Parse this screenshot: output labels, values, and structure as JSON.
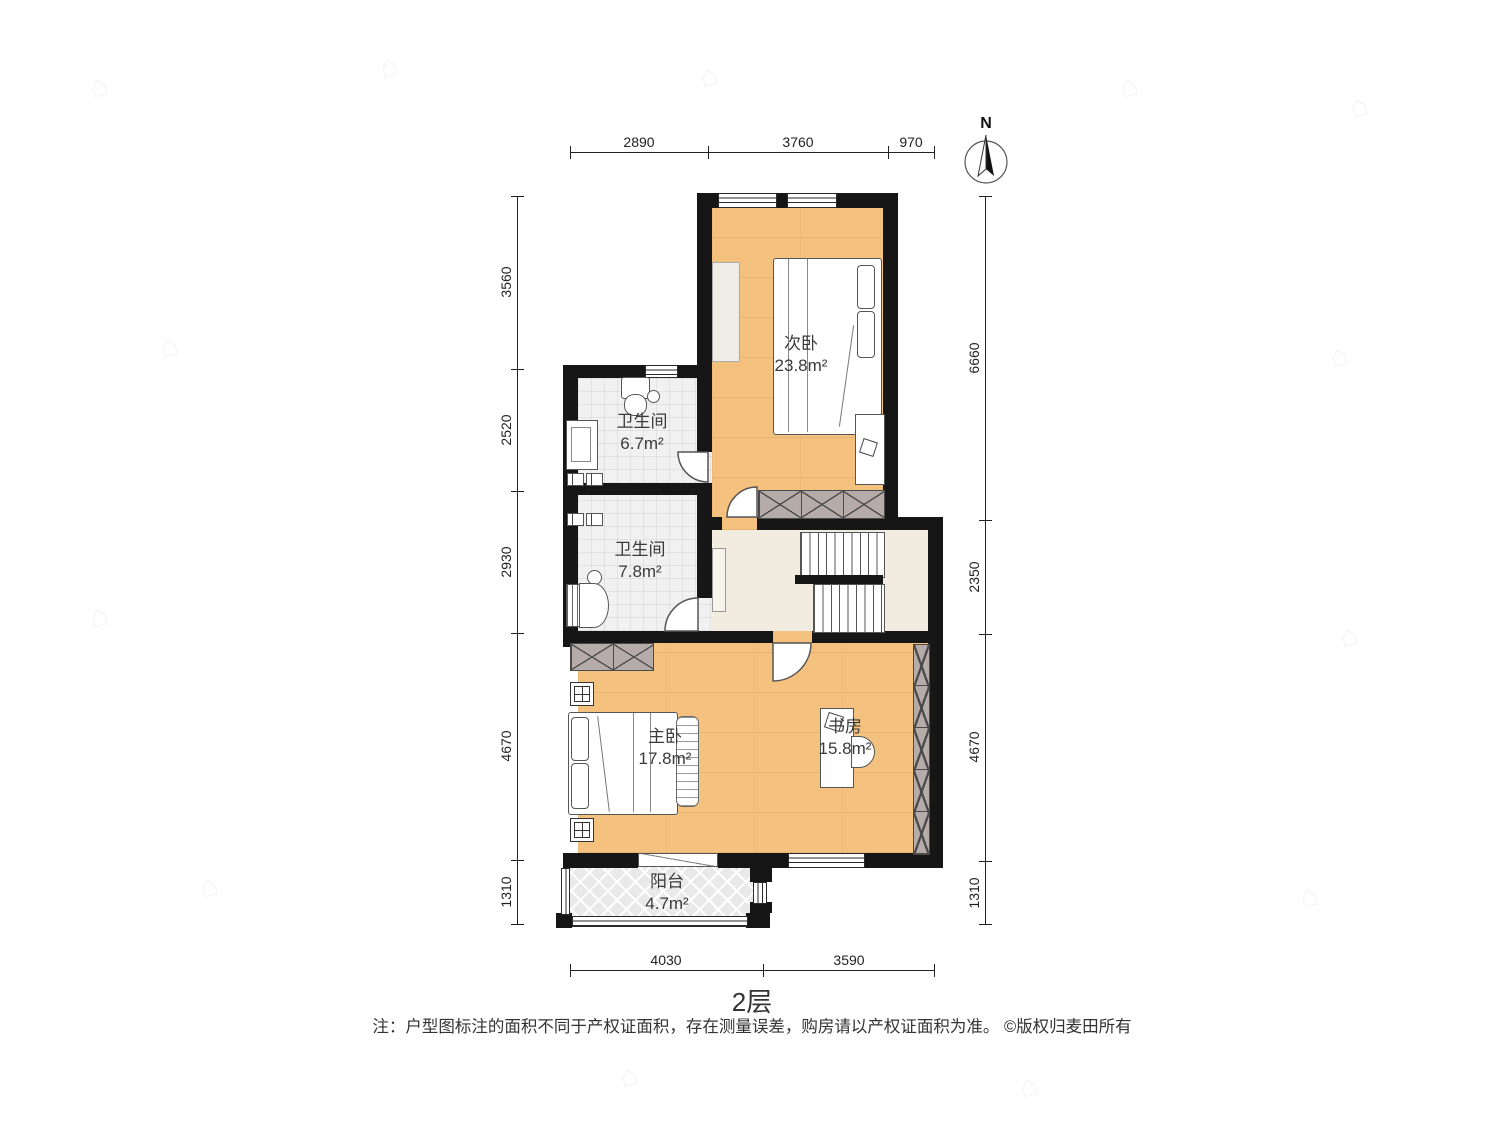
{
  "title": "2层",
  "note": "注：户型图标注的面积不同于产权证面积，存在测量误差，购房请以产权证面积为准。 ©版权归麦田所有",
  "compass": {
    "label": "N"
  },
  "dimensions": {
    "top": [
      "2890",
      "3760",
      "970"
    ],
    "bottom": [
      "4030",
      "3590"
    ],
    "left": [
      "3560",
      "2520",
      "2930",
      "4670",
      "1310"
    ],
    "right": [
      "6660",
      "2350",
      "4670",
      "1310"
    ]
  },
  "rooms": {
    "secondary_bedroom": {
      "name": "次卧",
      "area": "23.8m²"
    },
    "bathroom_upper": {
      "name": "卫生间",
      "area": "6.7m²"
    },
    "bathroom_lower": {
      "name": "卫生间",
      "area": "7.8m²"
    },
    "master_bedroom": {
      "name": "主卧",
      "area": "17.8m²"
    },
    "study": {
      "name": "书房",
      "area": "15.8m²"
    },
    "balcony": {
      "name": "阳台",
      "area": "4.7m²"
    }
  },
  "colors": {
    "wall": "#161616",
    "wood_floor": "#f5c17e",
    "tile_floor": "#f1f1f1",
    "hall_floor": "#f2ebdf",
    "hatch": "#b5aca9",
    "balcony_floor": "#e9e9e9"
  },
  "watermark": {
    "icon": "house-icon",
    "glyph": "⌂"
  }
}
